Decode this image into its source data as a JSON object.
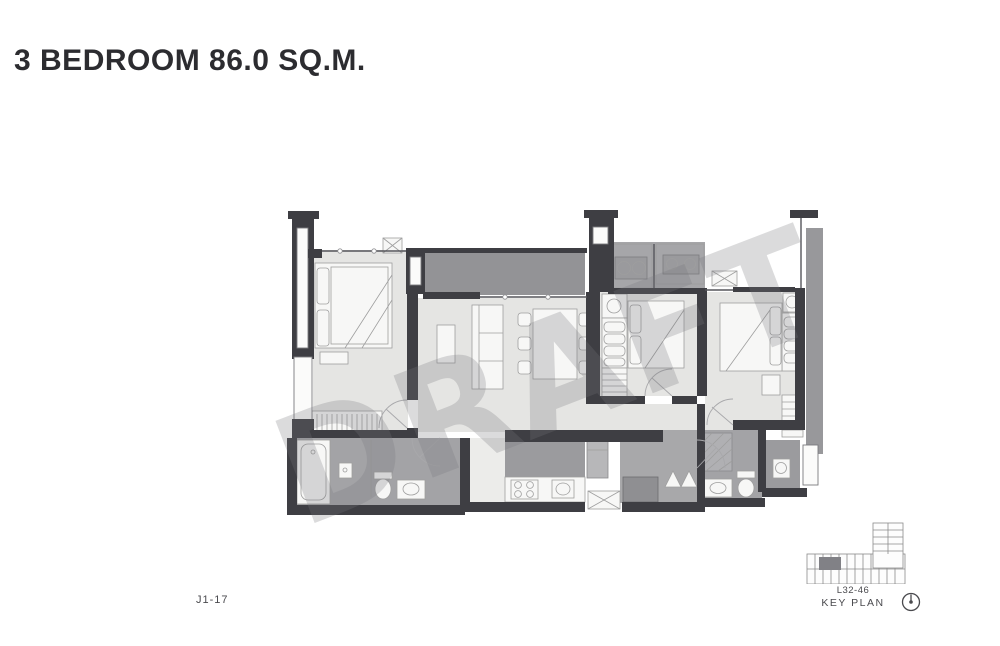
{
  "page": {
    "title": "3 BEDROOM 86.0 SQ.M.",
    "watermark_text": "DRAFT",
    "unit_label": "J1-17"
  },
  "key_plan": {
    "levels": "L32-46",
    "label": "KEY PLAN",
    "icons": {
      "building": "key-plan-building-icon",
      "north": "north-arrow-icon"
    }
  },
  "colors": {
    "wall": "#3e3e43",
    "floor": "#e5e5e3",
    "wet_floor": "#a3a3a6",
    "balcony": "#939396",
    "foyer": "#a8a8aa",
    "kitchen_back": "#9b9b9e",
    "right_ledge": "#98989b",
    "furniture_stroke": "#9e9e9e",
    "title_text": "#2c2c30",
    "label_text": "#4a4a4e",
    "watermark": "#77777c"
  }
}
